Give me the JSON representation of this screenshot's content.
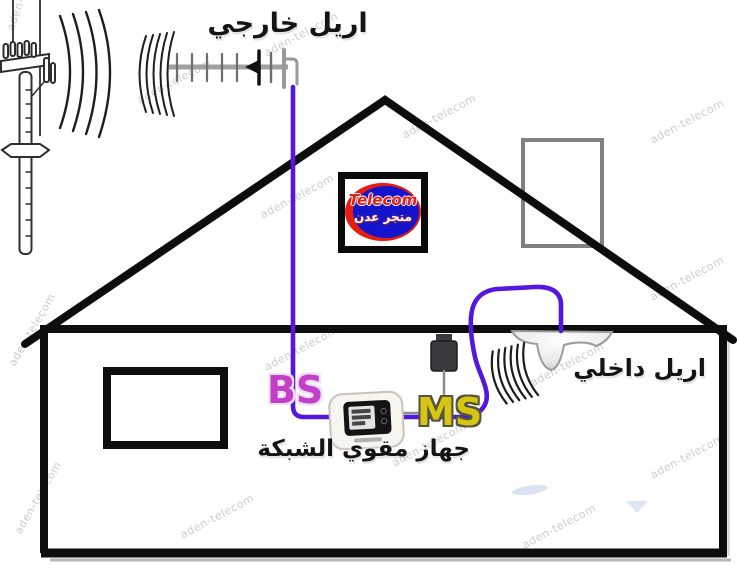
{
  "labels": {
    "external_antenna": "اريل خارجي",
    "internal_antenna": "اريل داخلي",
    "booster_device": "جهاز مقوي الشبكة",
    "bs": "BS",
    "ms": "MS"
  },
  "logo": {
    "brand": "Telecom",
    "subtitle": "متجر عدن"
  },
  "watermark": {
    "text": "aden-telecom"
  },
  "colors": {
    "cable": "#5417dd",
    "bs_text": "#c43fc9",
    "bs_outline": "#ecdff3",
    "ms_text": "#d6c513",
    "ms_outline": "#55553f",
    "logo_blue": "#1414cc",
    "logo_red": "#e41e10",
    "line": "#0d0d0d"
  }
}
